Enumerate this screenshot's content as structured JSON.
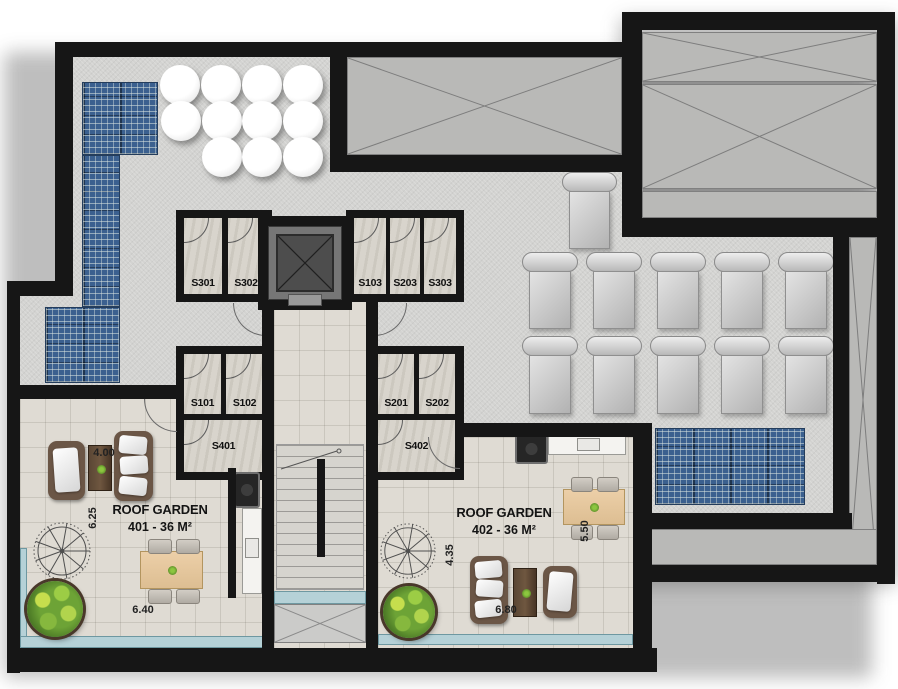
{
  "plan": {
    "rooms": [
      {
        "label": "S301"
      },
      {
        "label": "S302"
      },
      {
        "label": "S103"
      },
      {
        "label": "S203"
      },
      {
        "label": "S303"
      },
      {
        "label": "S101"
      },
      {
        "label": "S102"
      },
      {
        "label": "S401"
      },
      {
        "label": "S201"
      },
      {
        "label": "S202"
      },
      {
        "label": "S402"
      }
    ],
    "gardens": [
      {
        "title": "ROOF GARDEN",
        "unit": "401 - 36 M²",
        "dim_top": "4.00",
        "dim_left": "6.25",
        "dim_bottom": "6.40"
      },
      {
        "title": "ROOF GARDEN",
        "unit": "402 - 36 M²",
        "dim_left": "4.35",
        "dim_right": "5.50",
        "dim_bottom": "6.80"
      }
    ],
    "features": {
      "solar_arrays": 2,
      "sun_loungers": 11,
      "round_tables": 11,
      "spiral_stairs": 2,
      "skylights_crossed": 5
    },
    "colors": {
      "wall": "#161616",
      "deck": "#d3d3d1",
      "garden_floor": "#dfdbd3",
      "skylight": "#b9b9b7",
      "solar_panel": "#3b608f",
      "railing": "#b5d1d7",
      "plant": "#6da336",
      "wood_table": "#eccfa8",
      "dark_wood": "#5a4634"
    }
  }
}
